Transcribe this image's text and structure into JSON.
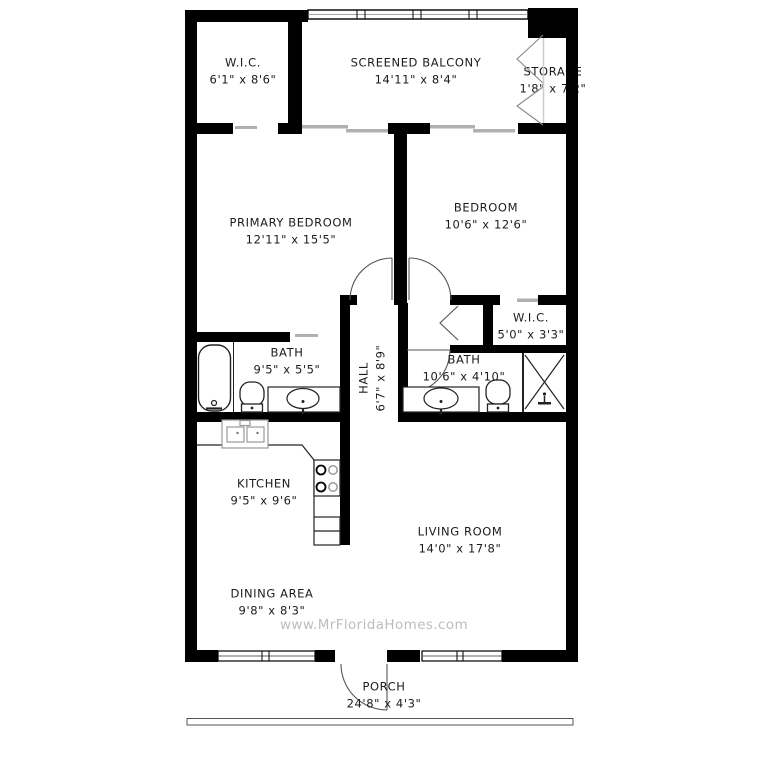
{
  "page": {
    "width": 759,
    "height": 768,
    "background": "#ffffff"
  },
  "watermark": "www.MrFloridaHomes.com",
  "colors": {
    "wall": "#000000",
    "line": "#2a2a2a",
    "door_arc": "#555555",
    "slider": "#b0b0b0",
    "light_line": "#999999",
    "label_text": "#1c1c1c",
    "watermark_text": "#bdbdbd"
  },
  "rooms": [
    {
      "id": "wic-top",
      "name": "W.I.C.",
      "dims": "6'1\" x 8'6\""
    },
    {
      "id": "balcony",
      "name": "SCREENED BALCONY",
      "dims": "14'11\" x 8'4\""
    },
    {
      "id": "storage",
      "name": "STORAGE",
      "dims": "1'8\" x 7'2\""
    },
    {
      "id": "primary",
      "name": "PRIMARY BEDROOM",
      "dims": "12'11\" x 15'5\""
    },
    {
      "id": "bedroom",
      "name": "BEDROOM",
      "dims": "10'6\" x 12'6\""
    },
    {
      "id": "wic-right",
      "name": "W.I.C.",
      "dims": "5'0\" x 3'3\""
    },
    {
      "id": "bath-1",
      "name": "BATH",
      "dims": "9'5\" x 5'5\""
    },
    {
      "id": "hall",
      "name": "HALL",
      "dims": "6'7\" x 8'9\""
    },
    {
      "id": "bath-2",
      "name": "BATH",
      "dims": "10'6\" x 4'10\""
    },
    {
      "id": "kitchen",
      "name": "KITCHEN",
      "dims": "9'5\" x 9'6\""
    },
    {
      "id": "living",
      "name": "LIVING ROOM",
      "dims": "14'0\" x 17'8\""
    },
    {
      "id": "dining",
      "name": "DINING AREA",
      "dims": "9'8\" x 8'3\""
    },
    {
      "id": "porch",
      "name": "PORCH",
      "dims": "24'8\" x 4'3\""
    }
  ]
}
